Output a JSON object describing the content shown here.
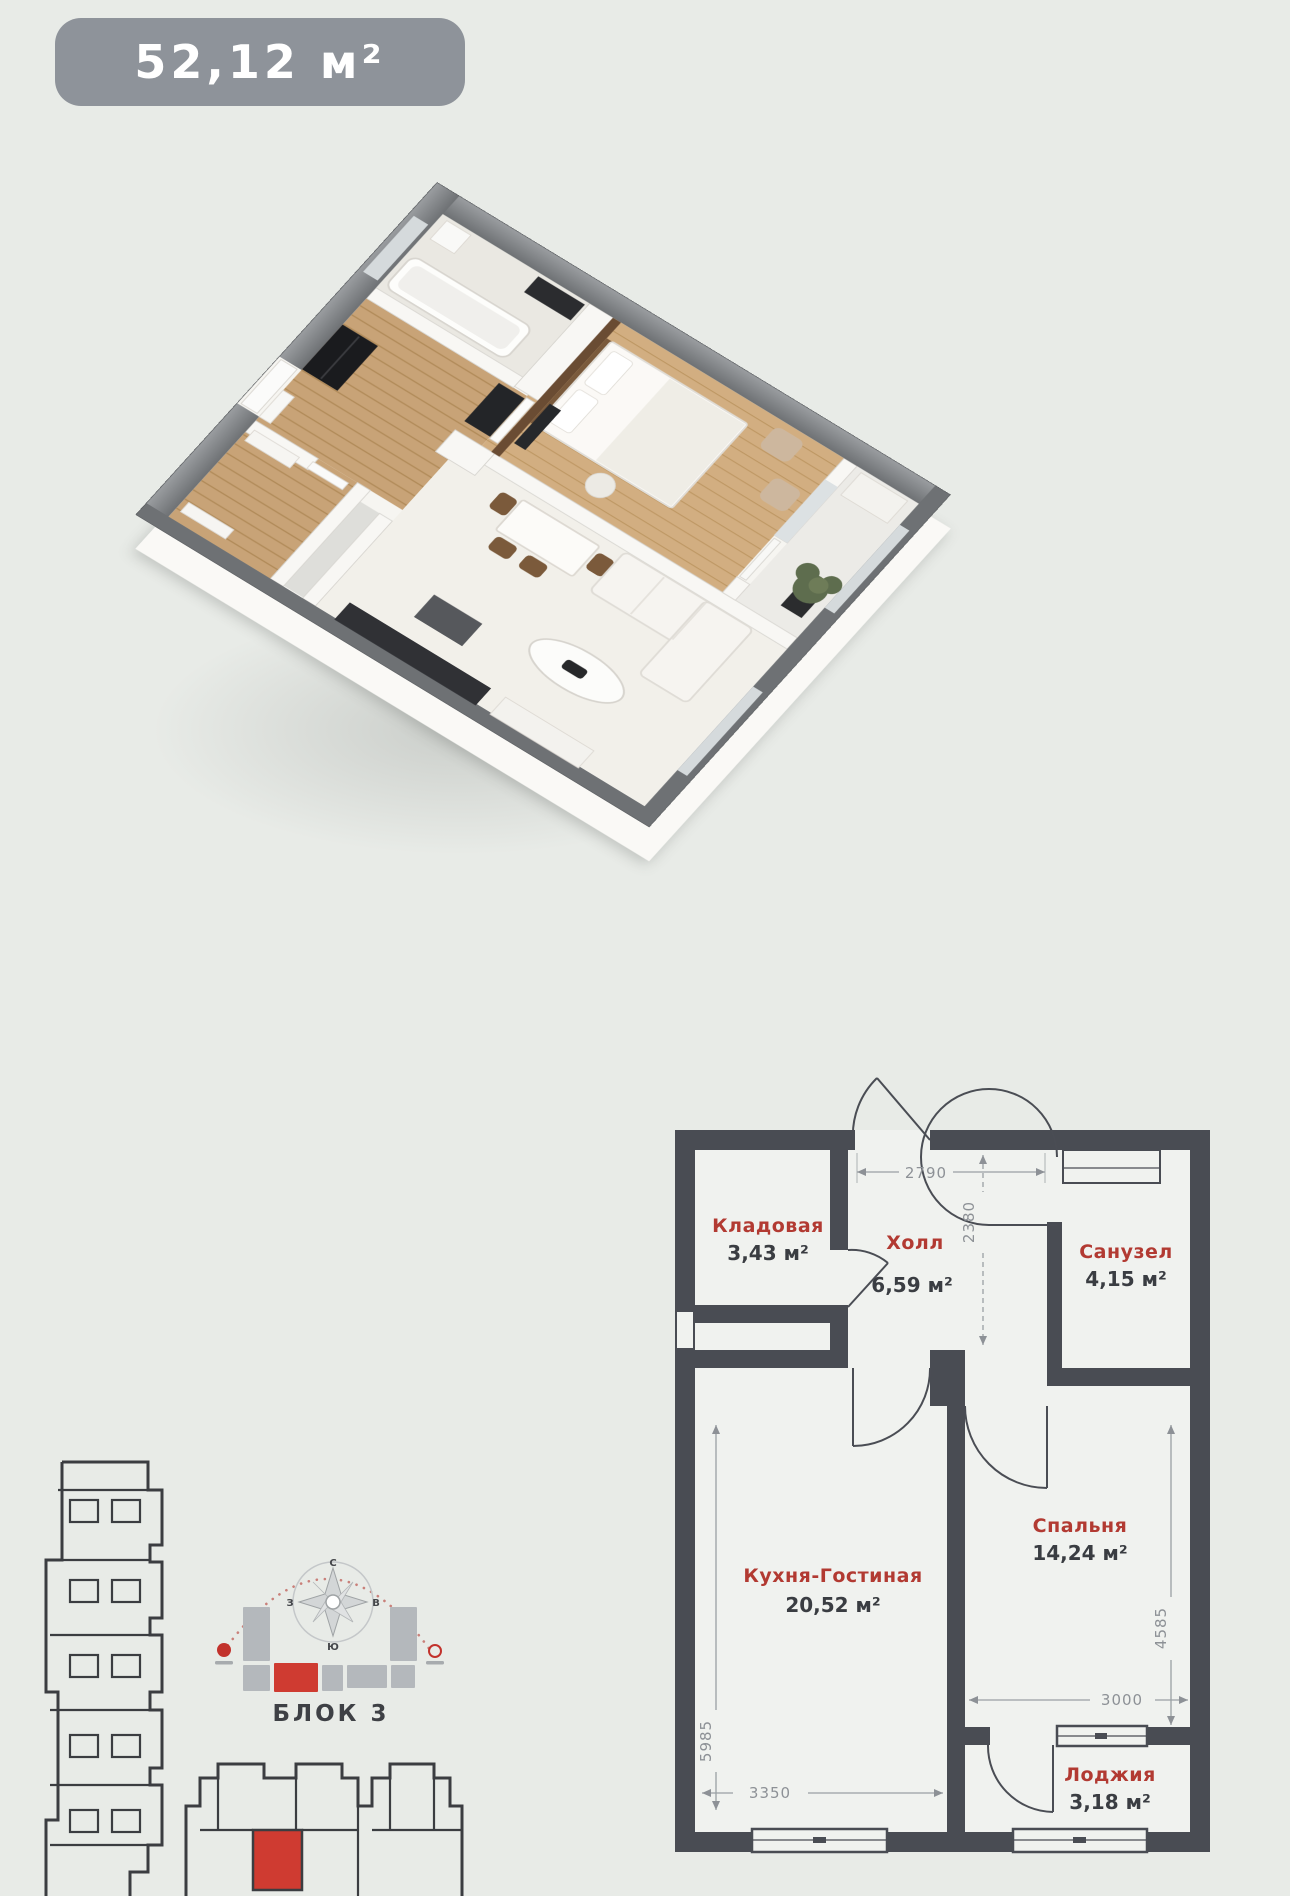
{
  "colors": {
    "background": "#e8ebe7",
    "badge_bg": "#8e939a",
    "plan_wall": "#494c53",
    "room_label_red": "#b23a32",
    "area_value_dark": "#3a3d42",
    "dimension_gray": "#8d9196",
    "accent_red": "#cf3b31"
  },
  "badge": {
    "area": "52,12 м²"
  },
  "floor_plan": {
    "rooms": [
      {
        "name": "Кладовая",
        "area": "3,43 м²"
      },
      {
        "name": "Холл",
        "area": "6,59 м²"
      },
      {
        "name": "Санузел",
        "area": "4,15 м²"
      },
      {
        "name": "Кухня-Гостиная",
        "area": "20,52 м²"
      },
      {
        "name": "Спальня",
        "area": "14,24 м²"
      },
      {
        "name": "Лоджия",
        "area": "3,18 м²"
      }
    ],
    "dimensions_mm": [
      "2790",
      "2380",
      "3350",
      "5985",
      "3000",
      "4585"
    ]
  },
  "block_plan": {
    "label": "БЛОК 3",
    "compass": {
      "north": "С",
      "east": "В",
      "south": "Ю",
      "west": "З"
    }
  }
}
